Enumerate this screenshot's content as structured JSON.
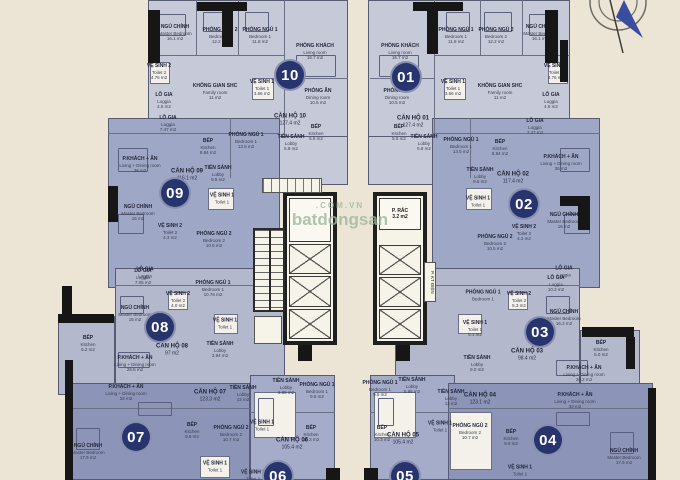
{
  "colors": {
    "background": "#ece5d6",
    "wall": "#161616",
    "badge": "#28346e",
    "watermark": "#9db89d",
    "north_arrow": "#3a4da0"
  },
  "watermark": {
    "line1": ".COM.VN",
    "line2": "batdongsan"
  },
  "core": {
    "trash_room": {
      "name": "P. RÁC",
      "area": "3.2 m2"
    },
    "electrical_room": "P. KT ĐIỆN"
  },
  "units": [
    {
      "number": "10",
      "name": "CĂN HỘ 10",
      "area": "127.4 m2",
      "color": "#c6c9d8",
      "rooms": [
        {
          "name": "NGỦ CHÍNH",
          "sub": "Master Bedroom",
          "area": "16.1 m2"
        },
        {
          "name": "PHÒNG NGỦ 2",
          "sub": "Bedroom 2",
          "area": "12.2 m2"
        },
        {
          "name": "PHÒNG NGỦ 1",
          "sub": "Bedroom 1",
          "area": "11.8 m2"
        },
        {
          "name": "PHÒNG KHÁCH",
          "sub": "Living room",
          "area": "16.7 m2"
        },
        {
          "name": "VỆ SINH 2",
          "sub": "Toilet 2",
          "area": "4.76 m2"
        },
        {
          "name": "KHÔNG GIAN SHC",
          "sub": "Family room",
          "area": "11 m2"
        },
        {
          "name": "VỆ SINH 1",
          "sub": "Toilet 1",
          "area": "3.66 m2"
        },
        {
          "name": "LÔ GIA",
          "sub": "Loggia",
          "area": "4.6 m2"
        },
        {
          "name": "PHÒNG ĂN",
          "sub": "Dining room",
          "area": "10.5 m2"
        },
        {
          "name": "BẾP",
          "sub": "Kitchen",
          "area": "5.5 m2"
        },
        {
          "name": "TIỀN SẢNH",
          "sub": "Lobby",
          "area": "5.8 m2"
        }
      ]
    },
    {
      "number": "01",
      "name": "CĂN HỘ 01",
      "area": "127.4 m2",
      "color": "#c6c9d8",
      "rooms": [
        {
          "name": "NGỦ CHÍNH",
          "sub": "Master Bedroom",
          "area": "16.1 m2"
        },
        {
          "name": "PHÒNG NGỦ 2",
          "sub": "Bedroom 2",
          "area": "12.2 m2"
        },
        {
          "name": "PHÒNG NGỦ 1",
          "sub": "Bedroom 1",
          "area": "11.8 m2"
        },
        {
          "name": "PHÒNG KHÁCH",
          "sub": "Living room",
          "area": "16.7 m2"
        },
        {
          "name": "VỆ SINH 2",
          "sub": "Toilet 2",
          "area": "4.76 m2"
        },
        {
          "name": "KHÔNG GIAN SHC",
          "sub": "Family room",
          "area": "11 m2"
        },
        {
          "name": "VỆ SINH 1",
          "sub": "Toilet 1",
          "area": "3.66 m2"
        },
        {
          "name": "LÔ GIA",
          "sub": "Loggia",
          "area": "4.6 m2"
        },
        {
          "name": "PHÒNG ĂN",
          "sub": "Dining room",
          "area": "10.5 m2"
        },
        {
          "name": "BẾP",
          "sub": "Kitchen",
          "area": "5.5 m2"
        },
        {
          "name": "TIỀN SẢNH",
          "sub": "Lobby",
          "area": "5.8 m2"
        }
      ]
    },
    {
      "number": "09",
      "name": "CĂN HỘ 09",
      "area": "116.1 m2",
      "color": "#9ea7c6",
      "rooms": [
        {
          "name": "LÔ GIA",
          "sub": "Loggia",
          "area": "7.47 m2"
        },
        {
          "name": "PHÒNG NGỦ 1",
          "sub": "Bedroom 1",
          "area": "13.5 m2"
        },
        {
          "name": "BẾP",
          "sub": "Kitchen",
          "area": "8.84 m2"
        },
        {
          "name": "P.KHÁCH + ĂN",
          "sub": "Living + Dining room",
          "area": "36 m2"
        },
        {
          "name": "TIỀN SẢNH",
          "sub": "Lobby",
          "area": "9.5 m2"
        },
        {
          "name": "VỆ SINH 1",
          "sub": "Toilet 1",
          "area": ""
        },
        {
          "name": "NGỦ CHÍNH",
          "sub": "Master Bedroom",
          "area": "16 m2"
        },
        {
          "name": "VỆ SINH 2",
          "sub": "Toilet 2",
          "area": "4.3 m2"
        },
        {
          "name": "PHÒNG NGỦ 2",
          "sub": "Bedroom 2",
          "area": "10.5 m2"
        },
        {
          "name": "LÔ GIA",
          "sub": "Loggia",
          "area": ""
        }
      ]
    },
    {
      "number": "02",
      "name": "CĂN HỘ 02",
      "area": "117.4 m2",
      "color": "#9ea7c6",
      "rooms": [
        {
          "name": "LÔ GIA",
          "sub": "Loggia",
          "area": "7.47 m2"
        },
        {
          "name": "PHÒNG NGỦ 1",
          "sub": "Bedroom 1",
          "area": "13.5 m2"
        },
        {
          "name": "BẾP",
          "sub": "Kitchen",
          "area": "8.84 m2"
        },
        {
          "name": "P.KHÁCH + ĂN",
          "sub": "Living + Dining room",
          "area": "36 m2"
        },
        {
          "name": "TIỀN SẢNH",
          "sub": "Lobby",
          "area": "9.5 m2"
        },
        {
          "name": "VỆ SINH 1",
          "sub": "Toilet 1",
          "area": ""
        },
        {
          "name": "NGỦ CHÍNH",
          "sub": "Master Bedroom",
          "area": "16 m2"
        },
        {
          "name": "VỆ SINH 2",
          "sub": "Toilet 2",
          "area": "4.3 m2"
        },
        {
          "name": "PHÒNG NGỦ 2",
          "sub": "Bedroom 2",
          "area": "10.5 m2"
        },
        {
          "name": "LÔ GIA",
          "sub": "Loggia",
          "area": ""
        }
      ]
    },
    {
      "number": "08",
      "name": "CĂN HỘ 08",
      "area": "97 m2",
      "color": "#b3b8cc",
      "rooms": [
        {
          "name": "LÔ GIA",
          "sub": "Loggia",
          "area": "7.05 m2"
        },
        {
          "name": "PHÒNG NGỦ 1",
          "sub": "Bedroom 1",
          "area": "10.76 m2"
        },
        {
          "name": "NGỦ CHÍNH",
          "sub": "Master Bedroom",
          "area": "15 m2"
        },
        {
          "name": "VỆ SINH 2",
          "sub": "Toilet 2",
          "area": "4.0 m2"
        },
        {
          "name": "VỆ SINH 1",
          "sub": "Toilet 1",
          "area": ""
        },
        {
          "name": "BẾP",
          "sub": "Kitchen",
          "area": "5.2 m2"
        },
        {
          "name": "TIỀN SẢNH",
          "sub": "Lobby",
          "area": "3.94 m2"
        },
        {
          "name": "P.KHÁCH + ĂN",
          "sub": "Living + Dining room",
          "area": "26.5 m2"
        }
      ]
    },
    {
      "number": "03",
      "name": "CĂN HỘ 03",
      "area": "98.4 m2",
      "color": "#b3b8cc",
      "rooms": [
        {
          "name": "LÔ GIA",
          "sub": "Loggia",
          "area": "10.2 m2"
        },
        {
          "name": "PHÒNG NGỦ 1",
          "sub": "Bedroom 1",
          "area": ""
        },
        {
          "name": "NGỦ CHÍNH",
          "sub": "Master Bedroom",
          "area": "16.2 m2"
        },
        {
          "name": "VỆ SINH 2",
          "sub": "Toilet 2",
          "area": "5.3 m2"
        },
        {
          "name": "VỆ SINH 1",
          "sub": "Toilet 1",
          "area": "5.1 m2"
        },
        {
          "name": "TIỀN SẢNH",
          "sub": "Lobby",
          "area": "9.0 m2"
        },
        {
          "name": "BẾP",
          "sub": "Kitchen",
          "area": "5.0 m2"
        },
        {
          "name": "P.KHÁCH + ĂN",
          "sub": "Living + Dining room",
          "area": "26.2 m2"
        }
      ]
    },
    {
      "number": "07",
      "name": "CĂN HỘ 07",
      "area": "123.3 m2",
      "color": "#8c95b7",
      "rooms": [
        {
          "name": "P.KHÁCH + ĂN",
          "sub": "Living + Dining room",
          "area": "32 m2"
        },
        {
          "name": "TIỀN SẢNH",
          "sub": "Lobby",
          "area": "12 m2"
        },
        {
          "name": "NGỦ CHÍNH",
          "sub": "Master Bedroom",
          "area": "17.5 m2"
        },
        {
          "name": "BẾP",
          "sub": "Kitchen",
          "area": "9.6 m2"
        },
        {
          "name": "PHÒNG NGỦ 2",
          "sub": "Bedroom 2",
          "area": "10.7 m2"
        },
        {
          "name": "VỆ SINH 1",
          "sub": "Toilet 1",
          "area": ""
        }
      ]
    },
    {
      "number": "06",
      "name": "CĂN HỘ 06",
      "area": "105.4 m2",
      "color": "#a5acca",
      "rooms": [
        {
          "name": "TIỀN SẢNH",
          "sub": "Lobby",
          "area": "5.85 m2"
        },
        {
          "name": "PHÒNG NGỦ 1",
          "sub": "Bedroom 1",
          "area": "9.5 m2"
        },
        {
          "name": "VỆ SINH 1",
          "sub": "Toilet 1",
          "area": ""
        },
        {
          "name": "BẾP",
          "sub": "Kitchen",
          "area": "10.3 m2"
        },
        {
          "name": "VỆ SINH 2",
          "sub": "Toilet 2",
          "area": ""
        }
      ]
    },
    {
      "number": "05",
      "name": "CĂN HỘ 05",
      "area": "105.4 m2",
      "color": "#a5acca",
      "rooms": [
        {
          "name": "PHÒNG NGỦ 1",
          "sub": "Bedroom 1",
          "area": "9.5 m2"
        },
        {
          "name": "TIỀN SẢNH",
          "sub": "Lobby",
          "area": "5.85 m2"
        },
        {
          "name": "BẾP",
          "sub": "Kitchen",
          "area": "10.3 m2"
        },
        {
          "name": "VỆ SINH 1",
          "sub": "Toilet 1",
          "area": ""
        }
      ]
    },
    {
      "number": "04",
      "name": "CĂN HỘ 04",
      "area": "123.1 m2",
      "color": "#8c95b7",
      "rooms": [
        {
          "name": "TIỀN SẢNH",
          "sub": "Lobby",
          "area": "12 m2"
        },
        {
          "name": "P.KHÁCH + ĂN",
          "sub": "Living + Dining room",
          "area": "32 m2"
        },
        {
          "name": "PHÒNG NGỦ 2",
          "sub": "Bedroom 2",
          "area": "10.7 m2"
        },
        {
          "name": "BẾP",
          "sub": "Kitchen",
          "area": "9.6 m2"
        },
        {
          "name": "NGỦ CHÍNH",
          "sub": "Master Bedroom",
          "area": "17.5 m2"
        },
        {
          "name": "VỆ SINH 1",
          "sub": "Toilet 1",
          "area": ""
        }
      ]
    }
  ]
}
